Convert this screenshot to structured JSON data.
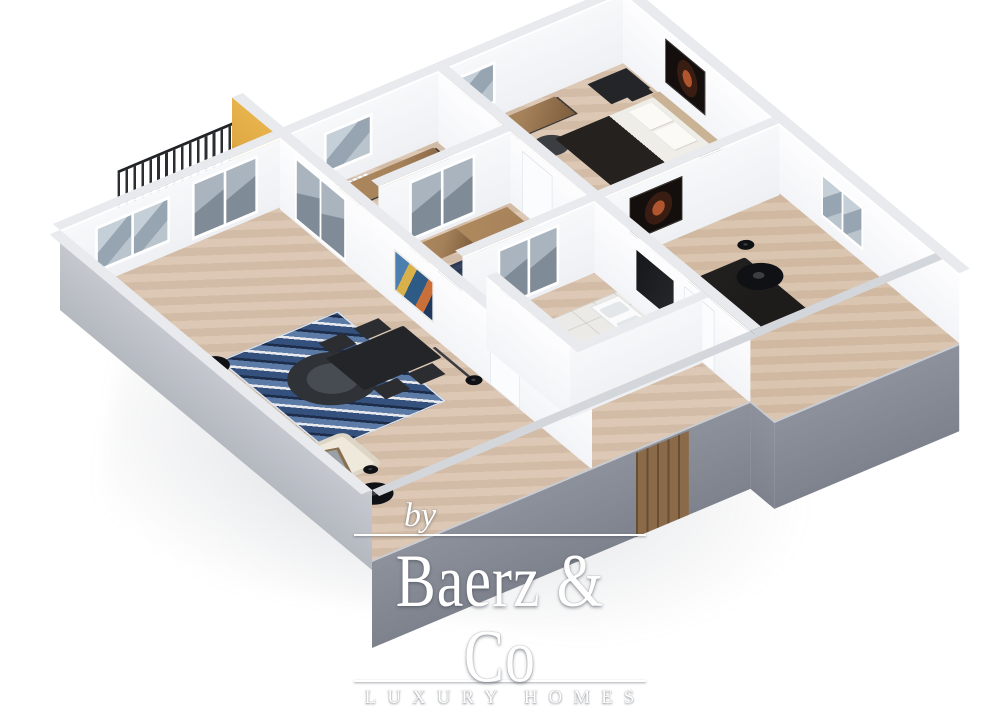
{
  "watermark": {
    "prefix": "by",
    "brand": "Baerz & Co",
    "tagline": "LUXURY HOMES"
  },
  "palette": {
    "floor-beige": "#d9c3ae",
    "floor-bed2": "#d6bfa9",
    "tile": "#eceae6",
    "wall-white": "#f3f4f7",
    "wall-face": "#eef0f3",
    "wall-top": "#e8eaee",
    "wall-gray": "#8d919c",
    "wall-outer": "#c7cad1",
    "accent-yellow": "#dfa943",
    "entry-wood": "#8a6a48",
    "rug-navy": "#2c3a55",
    "rug-blue": "#34507c",
    "wood": "#a5815a",
    "dark-furniture": "#232528",
    "sofa-cream": "#efe9dc",
    "bed-dark": "#1d1c1b",
    "headboard-tan": "#c9b394",
    "watermark-white": "#ffffff"
  },
  "scene": {
    "type": "3d-floor-plan-render",
    "rooms": [
      {
        "name": "living-room",
        "furniture": [
          "sofa",
          "chaise",
          "blue-pattern-rug",
          "round-coffee-table",
          "accent-chair",
          "dining-table",
          "dining-chairs",
          "ceiling-lamps",
          "floor-lamp",
          "window",
          "balcony-door"
        ]
      },
      {
        "name": "balcony",
        "furniture": [
          "railing",
          "yellow-accent-wall"
        ]
      },
      {
        "name": "office-1",
        "furniture": [
          "desk",
          "office-chair",
          "radiator",
          "window",
          "glass-doors"
        ]
      },
      {
        "name": "office-2",
        "furniture": [
          "l-desk",
          "office-chair",
          "navy-rug",
          "aquarium",
          "glass-doors"
        ]
      },
      {
        "name": "bedroom-1",
        "furniture": [
          "desk",
          "office-chair",
          "dresser",
          "double-bed",
          "pillows",
          "headboard",
          "nightstands",
          "dark-wall-art",
          "window"
        ]
      },
      {
        "name": "bedroom-2",
        "furniture": [
          "dark-bed",
          "tv-panel",
          "ceiling-lamp",
          "window"
        ]
      },
      {
        "name": "bathroom",
        "furniture": [
          "vanity-with-sinks",
          "shower",
          "toilet"
        ]
      },
      {
        "name": "hallway",
        "furniture": [
          "colorful-wall-art",
          "entry-door",
          "interior-doors"
        ]
      }
    ]
  }
}
